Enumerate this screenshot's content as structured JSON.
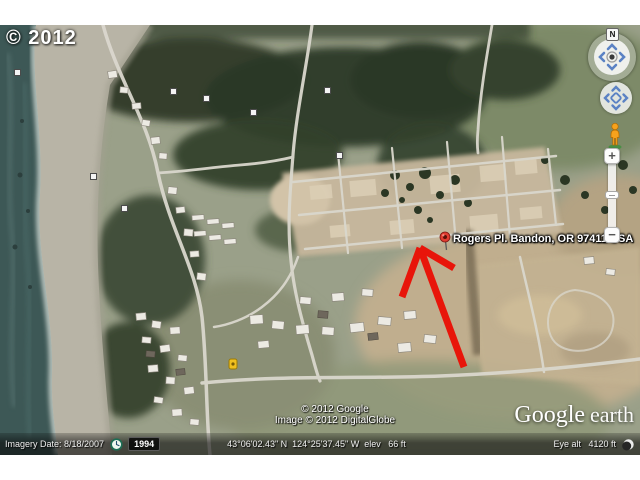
{
  "map": {
    "copyright": "© 2012",
    "placemark": {
      "label": "Rogers Pl. Bandon, OR 97411 USA"
    },
    "attribution": {
      "line1": "© 2012 Google",
      "line2": "Image © 2012 DigitalGlobe"
    },
    "logo": {
      "google": "Google",
      "earth": "earth"
    }
  },
  "navigation": {
    "compass_north": "N",
    "zoom_in": "+",
    "zoom_out": "−"
  },
  "status_bar": {
    "imagery_date": "Imagery Date: 8/18/2007",
    "history_year": "1994",
    "coordinates": "43°06'02.43\" N  124°25'37.45\" W  elev   66 ft",
    "eye_altitude": "Eye alt   4120 ft"
  },
  "icons": {
    "red_pushpin": "map-pin",
    "pegman": "street-view-person",
    "historical_clock": "clock",
    "streaming_indicator": "crescent-circle",
    "yellow_marker": "small-yellow-placemark",
    "photo_marker": "white-square-marker"
  },
  "colors": {
    "arrow_red": "#e8150a",
    "pin_red": "#e03c31",
    "ocean": "#3d5856",
    "beach": "#b8b4a6",
    "forest": "#2e3a27",
    "cleared_land": "#c8b89d",
    "road": "#dad7cd",
    "joystick_blue": "#5b82c4",
    "status_bar_text": "#efefef"
  }
}
